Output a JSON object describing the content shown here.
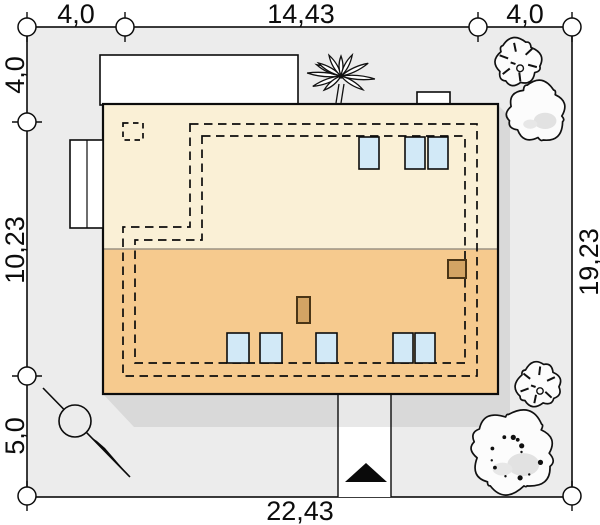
{
  "site_plan": {
    "dimensions": {
      "top_left": "4,0",
      "top_center": "14,43",
      "top_right": "4,0",
      "left_top": "4,0",
      "left_center": "10,23",
      "left_bottom": "5,0",
      "right_center": "19,23",
      "bottom_center": "22,43"
    }
  },
  "colors": {
    "plot_fill": "#ececec",
    "shadow": "#d9d9d9",
    "roof_upper": "#faf0d6",
    "roof_lower": "#f6ca8e",
    "window": "#d2e9f7",
    "chimney": "#d3a464",
    "driveway": "#ffffff",
    "driveway_shaded": "#e8e8e8",
    "tree_fill": "#fcfcfc",
    "outline": "#0c0c0c"
  }
}
